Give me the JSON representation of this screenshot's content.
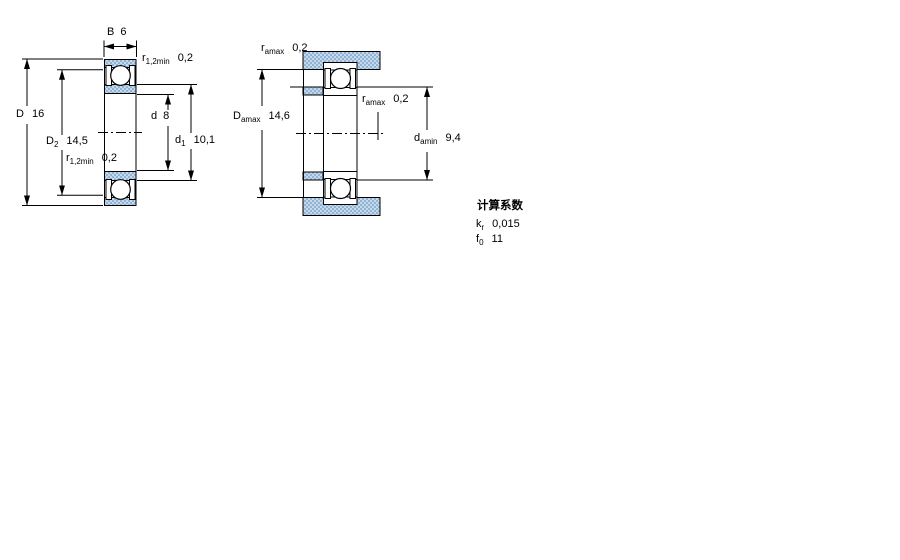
{
  "left_diagram": {
    "width_dim": {
      "symbol": "B",
      "sub": "",
      "value": "6"
    },
    "outer_diameter": {
      "symbol": "D",
      "sub": "",
      "value": "16"
    },
    "shoulder_outer": {
      "symbol": "D",
      "sub": "2",
      "value": "14,5"
    },
    "fillet_top": {
      "symbol": "r",
      "sub": "1,2min",
      "value": "0,2"
    },
    "fillet_bottom": {
      "symbol": "r",
      "sub": "1,2min",
      "value": "0,2"
    },
    "bore_diameter": {
      "symbol": "d",
      "sub": "",
      "value": "8"
    },
    "shoulder_inner": {
      "symbol": "d",
      "sub": "1",
      "value": "10,1"
    }
  },
  "right_diagram": {
    "housing_fillet": {
      "symbol": "r",
      "sub": "amax",
      "value": "0,2"
    },
    "housing_abutment": {
      "symbol": "D",
      "sub": "amax",
      "value": "14,6"
    },
    "shaft_fillet": {
      "symbol": "r",
      "sub": "amax",
      "value": "0,2"
    },
    "shaft_abutment": {
      "symbol": "d",
      "sub": "amin",
      "value": "9,4"
    }
  },
  "calculation_factors": {
    "title": "计算系数",
    "rows": [
      {
        "symbol": "k",
        "sub": "r",
        "value": "0,015"
      },
      {
        "symbol": "f",
        "sub": "0",
        "value": "11"
      }
    ]
  },
  "colors": {
    "line": "#000000",
    "hatch_light": "#c6d8ea",
    "hatch_dark": "#8fb4d4"
  }
}
